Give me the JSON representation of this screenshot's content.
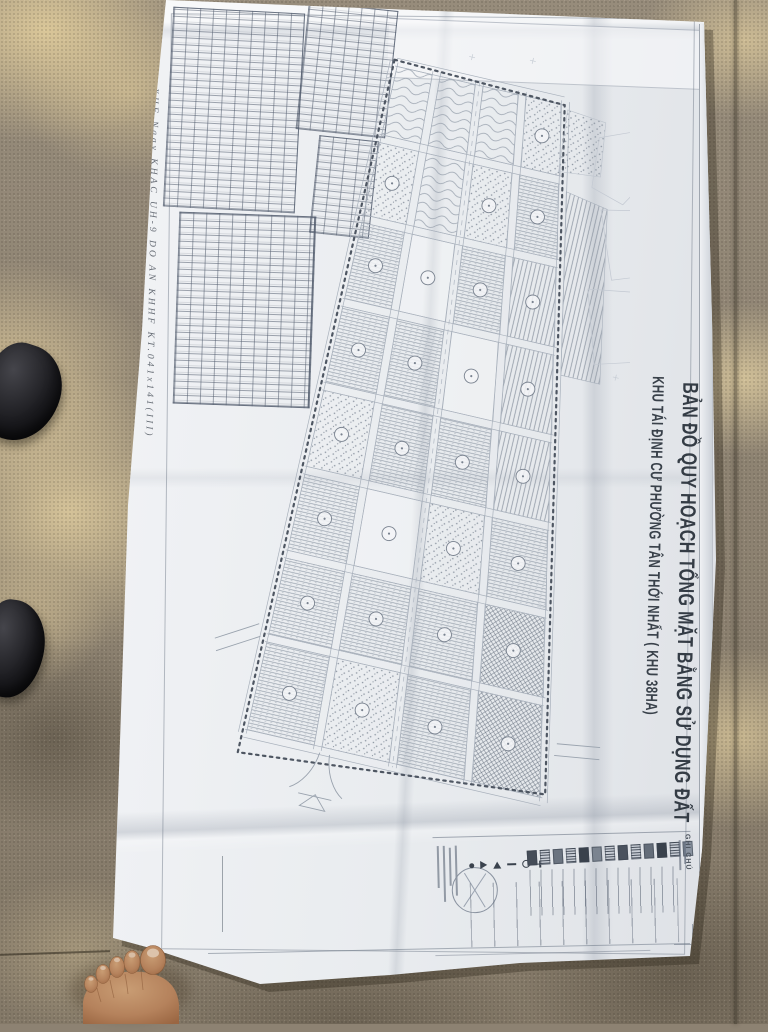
{
  "photo": {
    "title_block": {
      "line1": "KHU TÁI ĐỊNH CƯ PHƯỜNG TÂN THỚI NHẤT ( KHU 38HA)",
      "line2": "BẢN ĐỒ QUY HOẠCH TỔNG MẶT BẰNG SỬ DỤNG ĐẤT"
    },
    "legend": {
      "title": "GHI CHÚ"
    },
    "margin_note": "XHF Ngay KHAC UH-9 DO AN KHHF KT.041x141(III)",
    "colors": {
      "paper": "#edeff2",
      "map_ink": "#8d96a2",
      "title_ink": "#3a424b",
      "floor": "#8e8373",
      "sunlight": "#e2ce9e",
      "shoe": "#17171a",
      "skin": "#b5825c"
    }
  }
}
